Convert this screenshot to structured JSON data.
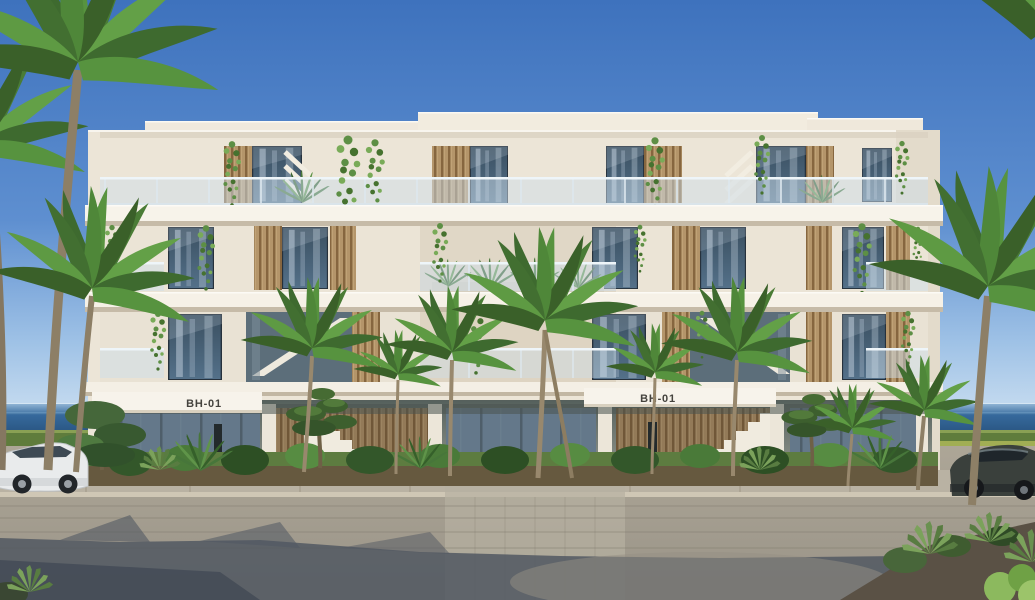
{
  "scene": {
    "type": "architectural-exterior-rendering",
    "description": "Front elevation rendering of a modern white low-rise apartment building (block BH-01) with timber slat screens, glass balconies, hanging planting, palm trees, two parked cars and a stone-paved forecourt, with the sea on the horizon.",
    "building": {
      "block_labels": {
        "left": "BH-01",
        "right": "BH-01"
      },
      "floors_visible": 4
    },
    "vehicles": {
      "left": "white SUV",
      "right": "dark grey SUV"
    },
    "colors": {
      "sky_top": "#3e72bd",
      "sky_horizon": "#d6e6f4",
      "sea": "#2c5d8f",
      "hedge": "#5f7c3c",
      "facade": "#ece5d7",
      "slab": "#f6f2e9",
      "timber_slats": "#b4956a",
      "window_glass": "#44607a",
      "balustrade_glass": "#cddee9",
      "foliage": "#4f7d3a",
      "pavement": "#a9a294",
      "foreground_shadow": "#515862",
      "label_text": "#45433e"
    }
  }
}
